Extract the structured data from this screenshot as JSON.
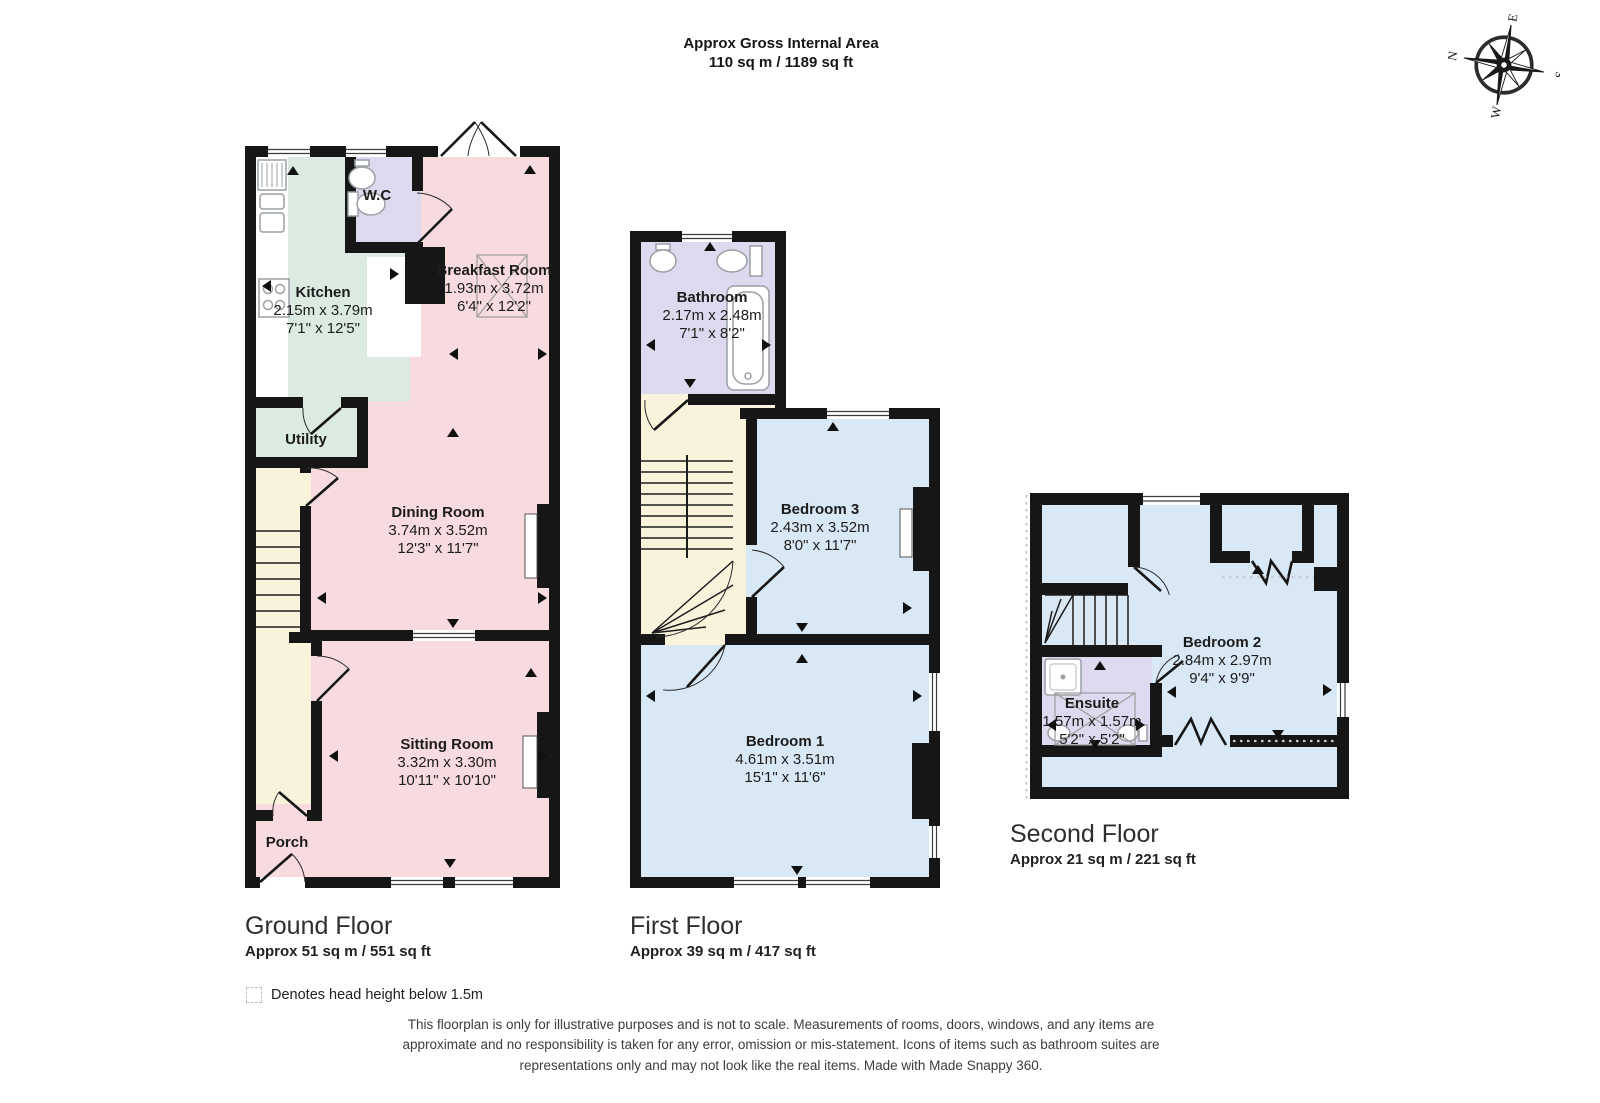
{
  "header": {
    "title": "Approx Gross Internal Area",
    "area": "110 sq m / 1189 sq ft"
  },
  "compass": {
    "n": "N",
    "e": "E",
    "s": "S",
    "w": "W"
  },
  "palette": {
    "pink": "#f8dbdf",
    "mint": "#dcebe2",
    "lavender": "#ded9ee",
    "blue": "#d9e8f5",
    "cream": "#faf3db",
    "wall": "#161616",
    "dots": "#c7ccd6",
    "fixture": "#9aa0a6"
  },
  "floors": {
    "ground": {
      "title": "Ground Floor",
      "area": "Approx 51 sq m / 551 sq ft",
      "rooms": {
        "kitchen": {
          "name": "Kitchen",
          "metric": "2.15m x 3.79m",
          "imperial": "7'1\" x 12'5\""
        },
        "wc": {
          "name": "W.C"
        },
        "breakfast": {
          "name": "Breakfast Room",
          "metric": "1.93m x 3.72m",
          "imperial": "6'4\" x 12'2\""
        },
        "utility": {
          "name": "Utility"
        },
        "dining": {
          "name": "Dining Room",
          "metric": "3.74m x 3.52m",
          "imperial": "12'3\" x 11'7\""
        },
        "sitting": {
          "name": "Sitting Room",
          "metric": "3.32m x 3.30m",
          "imperial": "10'11\" x 10'10\""
        },
        "porch": {
          "name": "Porch"
        }
      }
    },
    "first": {
      "title": "First Floor",
      "area": "Approx 39 sq m / 417 sq ft",
      "rooms": {
        "bathroom": {
          "name": "Bathroom",
          "metric": "2.17m x 2.48m",
          "imperial": "7'1\" x 8'2\""
        },
        "bedroom3": {
          "name": "Bedroom 3",
          "metric": "2.43m x 3.52m",
          "imperial": "8'0\" x 11'7\""
        },
        "bedroom1": {
          "name": "Bedroom 1",
          "metric": "4.61m x 3.51m",
          "imperial": "15'1\" x 11'6\""
        }
      }
    },
    "second": {
      "title": "Second Floor",
      "area": "Approx 21 sq m / 221 sq ft",
      "rooms": {
        "bedroom2": {
          "name": "Bedroom 2",
          "metric": "2.84m x 2.97m",
          "imperial": "9'4\" x 9'9\""
        },
        "ensuite": {
          "name": "Ensuite",
          "metric": "1.57m x 1.57m",
          "imperial": "5'2\" x 5'2\""
        }
      }
    }
  },
  "legend": {
    "label": "Denotes head height below 1.5m"
  },
  "disclaimer": "This floorplan is only for illustrative purposes and is not to scale. Measurements of rooms, doors, windows, and any items are approximate and no responsibility is taken for any error, omission or mis-statement. Icons of items such as bathroom suites are representations only and may not look like the real items. Made with Made Snappy 360."
}
